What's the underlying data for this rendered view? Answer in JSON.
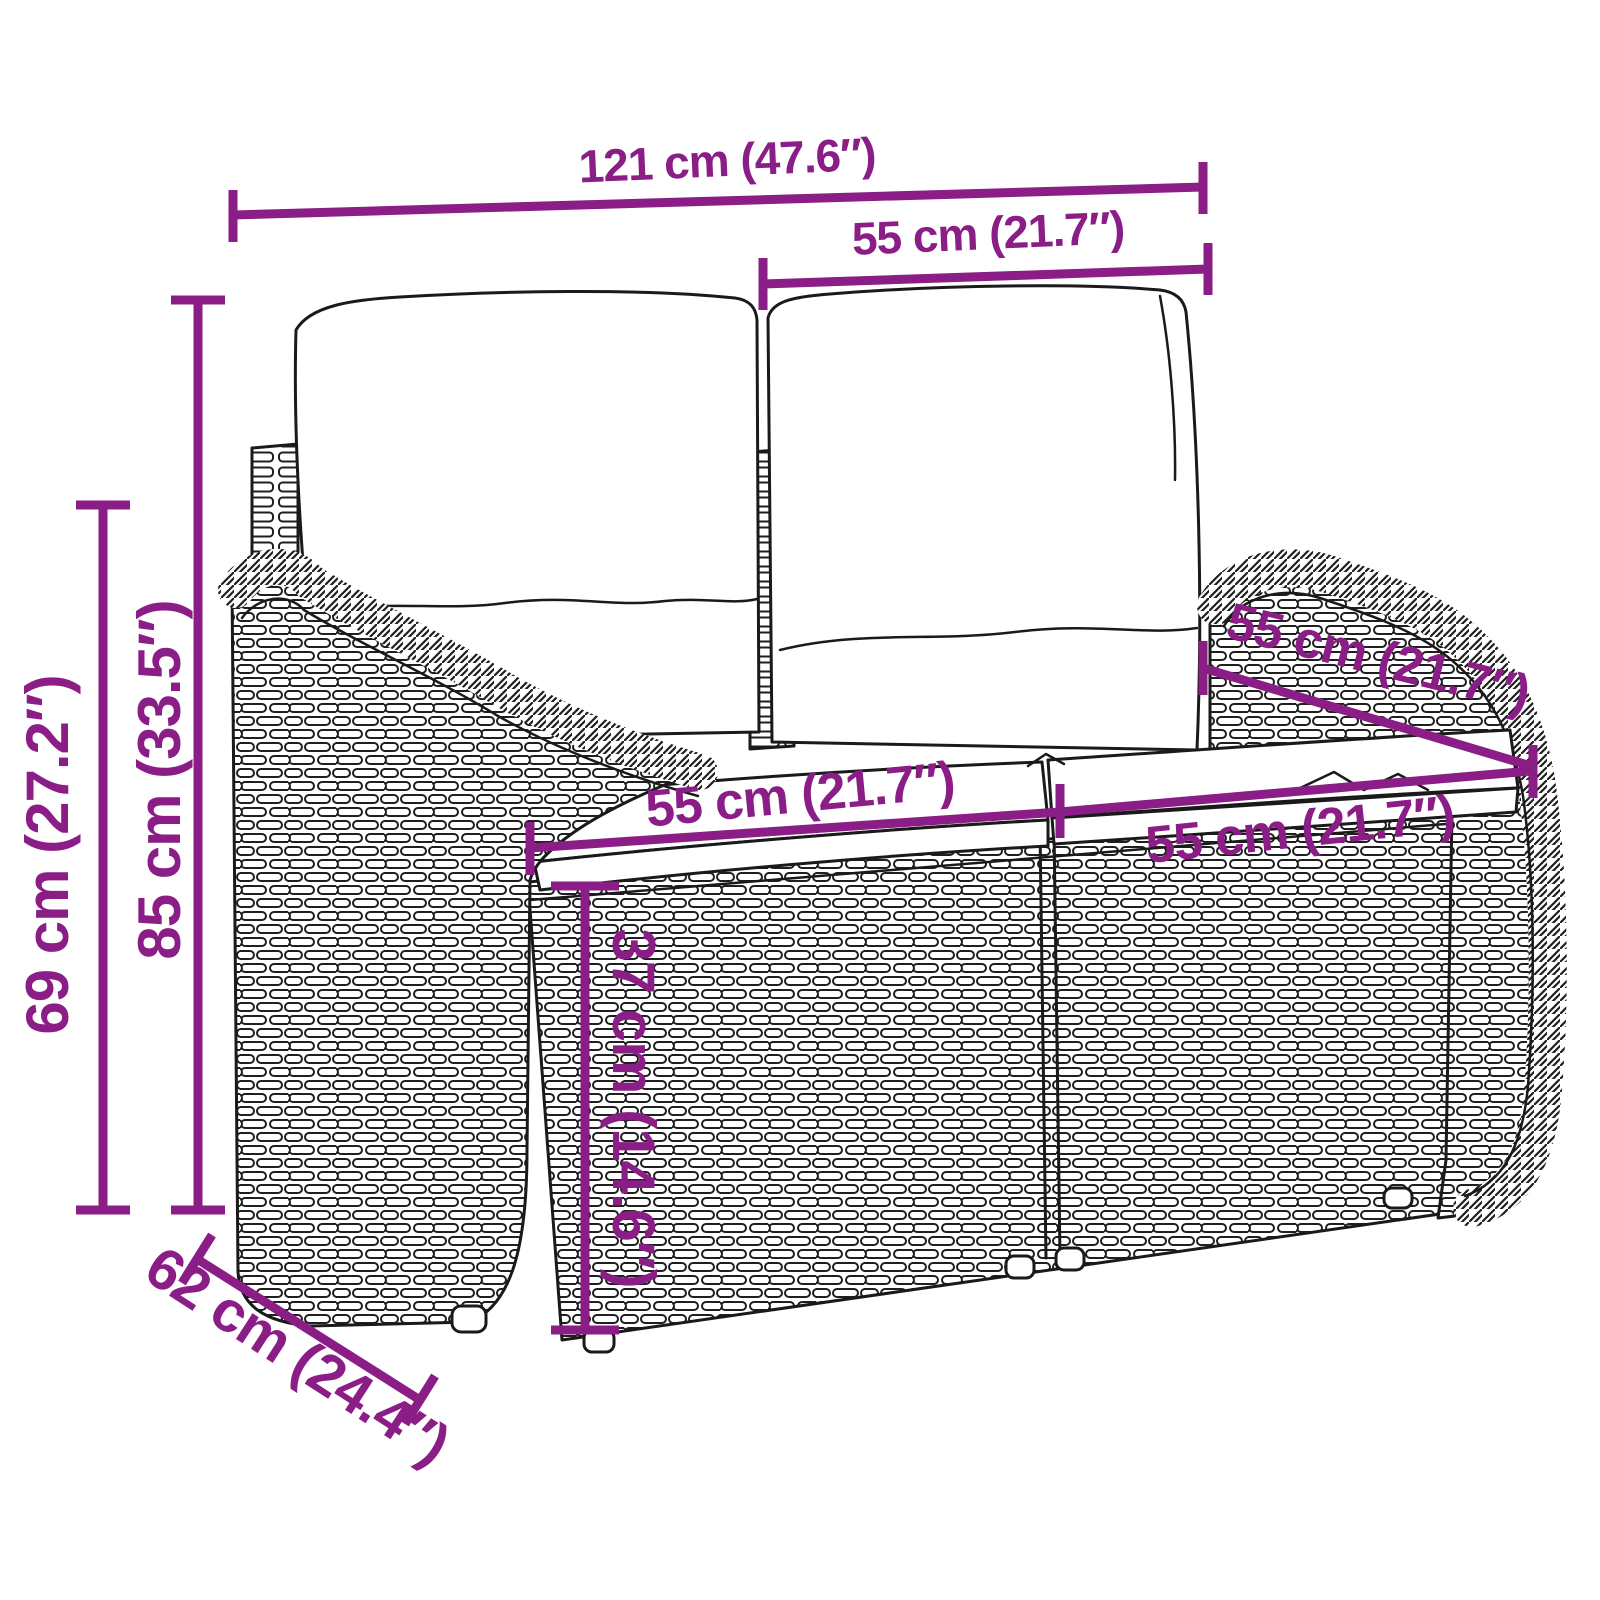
{
  "diagram": {
    "subject": "poly-rattan garden bench with back cushions and seat cushions",
    "style": "black line-art product drawing with purple dimension annotations",
    "accent_color": "#8B1D87",
    "outline_color": "#1A1A1A",
    "background_color": "#FFFFFF",
    "dimensions": {
      "total_width": "121 cm (47.6″)",
      "back_cushion_width": "55 cm (21.7″)",
      "total_height": "85 cm (33.5″)",
      "armrest_height": "69 cm (27.2″)",
      "seat_cushion_left_width": "55 cm (21.7″)",
      "seat_cushion_right_width": "55 cm (21.7″)",
      "seat_depth": "55 cm (21.7″)",
      "seat_height": "37 cm (14.6″)",
      "total_depth": "62 cm (24.4″)"
    }
  }
}
